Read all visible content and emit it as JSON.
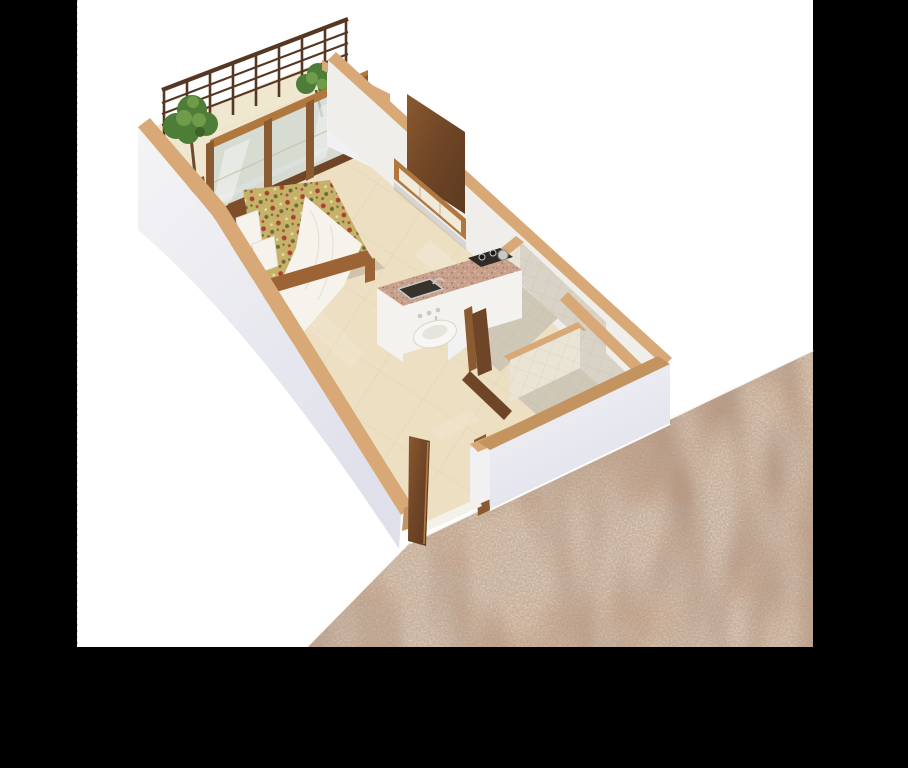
{
  "canvas": {
    "width": 908,
    "height": 768
  },
  "frame": {
    "background": "#000000",
    "page_white": "#ffffff",
    "white_area": {
      "x": 77,
      "y": 0,
      "width": 736,
      "height": 647
    },
    "edge_tick_color": "#c4c4c4"
  },
  "scene": {
    "type": "isometric-3d-floor-plan-render",
    "rooms": [
      "balcony",
      "bedroom",
      "kitchen",
      "wash-area",
      "bathroom",
      "toilet",
      "duct",
      "entrance-corridor"
    ],
    "objects": [
      "balcony-railing",
      "potted-plant-left",
      "potted-plant-right",
      "ac-unit-box",
      "sliding-glass-door",
      "double-bed",
      "pillows",
      "throw-blanket",
      "bedside-table",
      "table-lamp",
      "tv-panel",
      "tv-cabinet",
      "kitchen-counter",
      "kitchen-sink",
      "gas-stove",
      "wash-basin",
      "bathroom-door",
      "toilet-door",
      "entrance-door",
      "corridor-granite-floor"
    ]
  },
  "colors": {
    "wall_cap": "#d8a977",
    "wall_cap_dark": "#c3945f",
    "wall_face": "#f1f1f4",
    "wall_face_shade": "#e2e3ec",
    "wall_inner": "#efeeeb",
    "floor": "#ecdfc2",
    "floor_line": "#ddd0b0",
    "balcony_floor": "#efe7d0",
    "bath_floor": "#cfc8b7",
    "bath_floor_line": "#bfb9a8",
    "tile": "#e9e4d5",
    "tile_line": "#d4cebd",
    "wood_dark": "#6e4526",
    "wood": "#8a5a30",
    "wood_light": "#b0783f",
    "rail": "#553823",
    "glass": "#cfd9d4",
    "glass_streak": "#ffffff",
    "plant": "#4e7d38",
    "plant_light": "#6f9c4a",
    "plant_dark": "#3c6229",
    "trunk": "#6b4a2e",
    "bed_frame": "#9c6434",
    "headboard": "#7d4e28",
    "spread": "#c6b169",
    "spread_red": "#a84333",
    "spread_olive": "#6f6b38",
    "spread_cream": "#e9dda6",
    "linen": "#f6f3ec",
    "linen_shade": "#e4ddcd",
    "counter_granite": "#c8a08c",
    "counter_speck_dark": "#9e7863",
    "counter_speck_light": "#e3c6b2",
    "counter_face": "#f3f2ee",
    "sink": "#37322c",
    "steel": "#c8c8c6",
    "stove": "#2f2b28",
    "basin": "#f6f6f3",
    "lamp_glow": "#f4c56a",
    "corridor_granite": "#c49a7d",
    "drawer": "#f0ead9",
    "white_box": "#f6f6f4",
    "threshold": "#f5f1e8",
    "shadow": "#000000"
  }
}
